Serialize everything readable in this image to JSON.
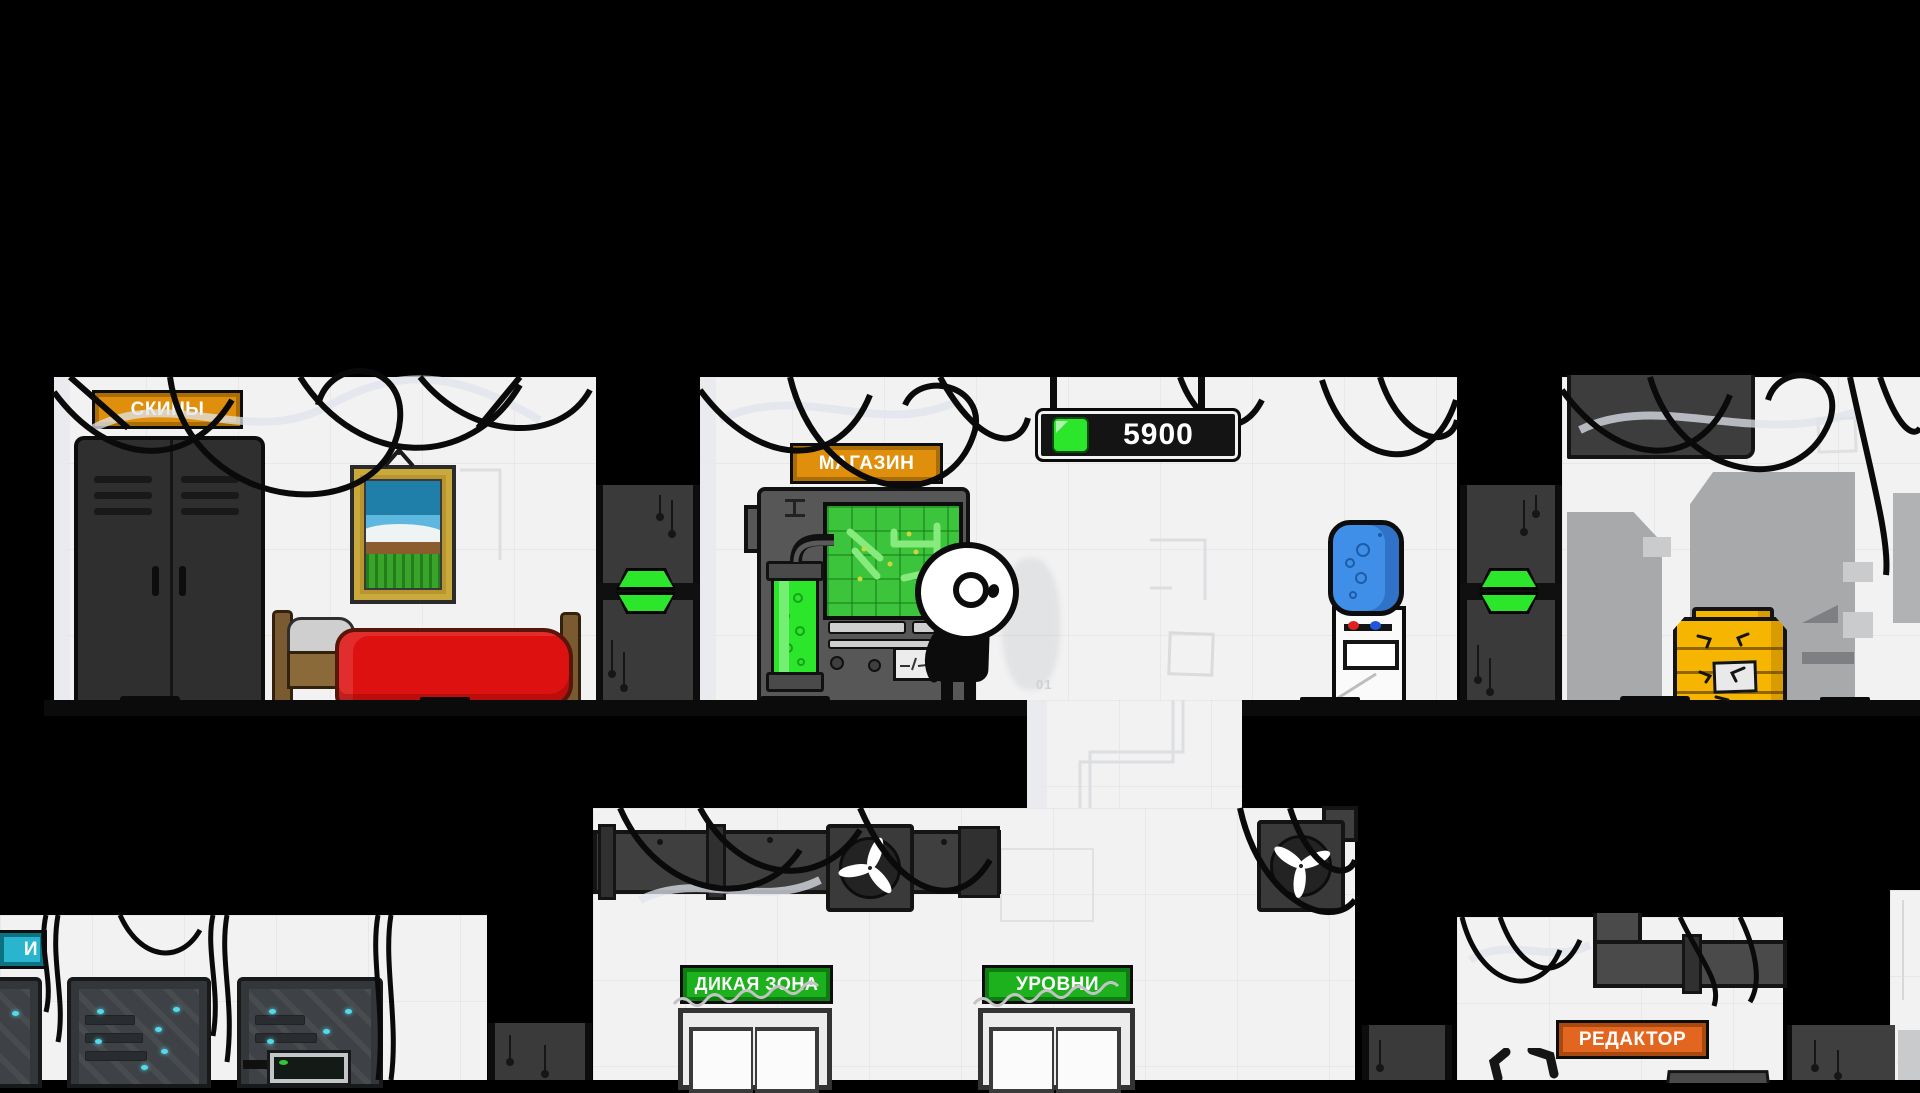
{
  "currency": {
    "value": "5900"
  },
  "signs": {
    "skins": {
      "label": "СКИНЫ"
    },
    "shop": {
      "label": "МАГАЗИН"
    },
    "wild_zone": {
      "label": "ДИКАЯ ЗОНА"
    },
    "levels": {
      "label": "УРОВНИ"
    },
    "editor": {
      "label": "РЕДАКТОР"
    },
    "skills_partial": {
      "label": "И"
    }
  },
  "graffiti": {
    "wall_mark": "01"
  },
  "icons": {
    "currency_gem": "square-gem",
    "door_indicator": "split-green-hexagon",
    "ceiling_fan": "three-blade-propeller"
  },
  "colors": {
    "wall": "#f2f2f3",
    "accent_orange": "#df8f0b",
    "accent_orange_border": "#aa6d05",
    "editor_orange": "#e2661f",
    "editor_orange_border": "#a84a10",
    "sign_green": "#1db11d",
    "sign_green_border": "#0e7c12",
    "cyan": "#29b5cd",
    "cyan_border": "#0d7184",
    "gem_green": "#2ce62c",
    "screen_green": "#3cc43c",
    "blanket_red": "#de1111",
    "crate_yellow": "#f6b500",
    "bottle_blue": "#3f8fe8",
    "panel_dark": "#3d3d3d"
  }
}
